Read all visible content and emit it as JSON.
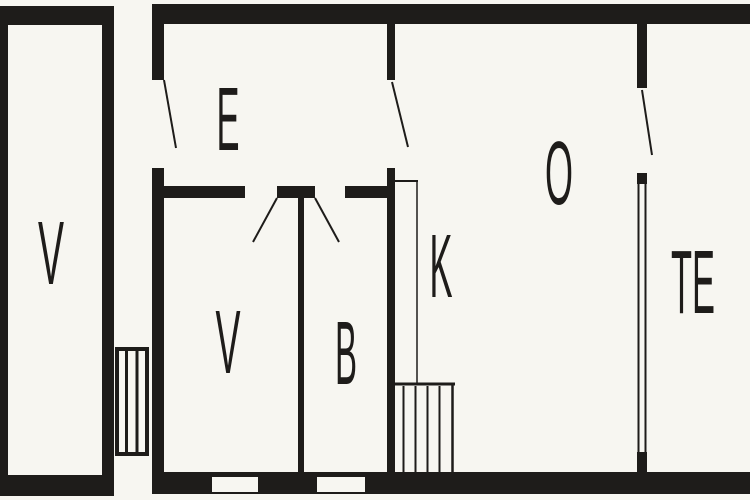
{
  "page": {
    "type": "floor-plan"
  },
  "colors": {
    "background": "#f7f6f1",
    "wall": "#1e1c1a",
    "label": "#1e1c1a"
  },
  "rooms": [
    {
      "id": "annex-v",
      "label": "V"
    },
    {
      "id": "entry-e",
      "label": "E"
    },
    {
      "id": "room-v",
      "label": "V"
    },
    {
      "id": "room-b",
      "label": "B"
    },
    {
      "id": "room-k",
      "label": "K"
    },
    {
      "id": "room-o",
      "label": "O"
    },
    {
      "id": "room-te",
      "label": "TE"
    }
  ]
}
